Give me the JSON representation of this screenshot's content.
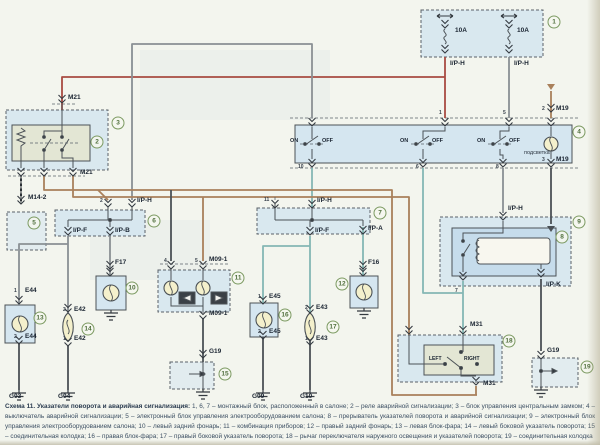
{
  "caption": {
    "title": "Схема 11. Указатели поворота и аварийная сигнализация:",
    "body": " 1, 6, 7 – монтажный блок, расположенный в салоне; 2 – реле аварийной сигнализации; 3 – блок управления центральным замком; 4 – выключатель аварийной сигнализации; 5 – электронный блок управления электрооборудованием салона; 8 – прерыватель указателей поворота и аварийной сигнализации; 9 – электронный блок управления электрооборудованием салона; 10 – левый задний фонарь; 11 – комбинация приборов; 12 – правый задний фонарь; 13 – левая блок-фара; 14 – левый боковой указатель поворота; 15 – соединительная колодка; 16 – правая блок-фара; 17 – правый боковой указатель поворота; 18 – рычаг переключателя наружного освещения и указателей поворота; 19 – соединительная колодка"
  },
  "colors": {
    "wire_red": "#a84b42",
    "wire_gray": "#8a9094",
    "wire_brown": "#a9805b",
    "wire_teal": "#84b7b4",
    "wire_dark": "#4b5156",
    "block_fill": "#cfe3f0",
    "inner_green": "#e3e6d4",
    "lamp_fill": "#f4f0cc",
    "ref_green": "#7c9a62"
  },
  "fuses": [
    {
      "rating": "10A",
      "output": "I/P-H"
    },
    {
      "rating": "10A",
      "output": "I/P-H"
    }
  ],
  "labels": [
    {
      "n": "fuse1-rating",
      "t": "10A",
      "x": 455,
      "y": 27
    },
    {
      "n": "fuse2-rating",
      "t": "10A",
      "x": 517,
      "y": 27
    },
    {
      "n": "fuse1-output",
      "t": "I/P-H",
      "x": 450,
      "y": 60
    },
    {
      "n": "fuse2-output",
      "t": "I/P-H",
      "x": 514,
      "y": 60
    },
    {
      "n": "m19-top-pin",
      "t": "2",
      "x": 542,
      "y": 106,
      "c": "sm"
    },
    {
      "n": "m19-top",
      "t": "M19",
      "x": 556,
      "y": 105
    },
    {
      "n": "m19-bottom-pin",
      "t": "3",
      "x": 542,
      "y": 157,
      "c": "sm"
    },
    {
      "n": "m19-bottom",
      "t": "M19",
      "x": 556,
      "y": 156
    },
    {
      "n": "sw1-on",
      "t": "ON",
      "x": 290,
      "y": 138,
      "c": "on"
    },
    {
      "n": "sw1-off",
      "t": "OFF",
      "x": 322,
      "y": 138,
      "c": "on"
    },
    {
      "n": "sw2-on",
      "t": "ON",
      "x": 400,
      "y": 138,
      "c": "on"
    },
    {
      "n": "sw2-off",
      "t": "OFF",
      "x": 432,
      "y": 138,
      "c": "on"
    },
    {
      "n": "sw3-on",
      "t": "ON",
      "x": 477,
      "y": 138,
      "c": "on"
    },
    {
      "n": "sw3-off",
      "t": "OFF",
      "x": 509,
      "y": 138,
      "c": "on"
    },
    {
      "n": "illumination",
      "t": "подсветка",
      "x": 524,
      "y": 150,
      "c": "ru"
    },
    {
      "n": "m21-top",
      "t": "M21",
      "x": 68,
      "y": 94
    },
    {
      "n": "m21-bottom",
      "t": "M21",
      "x": 80,
      "y": 169
    },
    {
      "n": "m14-2",
      "t": "M14-2",
      "x": 28,
      "y": 194
    },
    {
      "n": "b6-pin2",
      "t": "2",
      "x": 100,
      "y": 198,
      "c": "sm"
    },
    {
      "n": "b6-iph",
      "t": "I/P-H",
      "x": 137,
      "y": 197
    },
    {
      "n": "b6-ipf",
      "t": "I/P-F",
      "x": 73,
      "y": 227
    },
    {
      "n": "b6-ipb",
      "t": "I/P-B",
      "x": 115,
      "y": 227
    },
    {
      "n": "f17",
      "t": "F17",
      "x": 115,
      "y": 259
    },
    {
      "n": "b7-pin11",
      "t": "11",
      "x": 264,
      "y": 197,
      "c": "sm"
    },
    {
      "n": "b7-iph",
      "t": "I/P-H",
      "x": 317,
      "y": 197
    },
    {
      "n": "b7-ipf",
      "t": "I/P-F",
      "x": 315,
      "y": 227
    },
    {
      "n": "b7-ipa",
      "t": "I/P-A",
      "x": 368,
      "y": 225
    },
    {
      "n": "f16",
      "t": "F16",
      "x": 368,
      "y": 259
    },
    {
      "n": "m09-top",
      "t": "M09-1",
      "x": 209,
      "y": 256
    },
    {
      "n": "m09-pin4",
      "t": "4",
      "x": 164,
      "y": 258,
      "c": "sm"
    },
    {
      "n": "m09-pin5",
      "t": "5",
      "x": 195,
      "y": 258,
      "c": "sm"
    },
    {
      "n": "m09-bottom",
      "t": "M09-1",
      "x": 209,
      "y": 310
    },
    {
      "n": "g19-cluster",
      "t": "G19",
      "x": 209,
      "y": 348
    },
    {
      "n": "b9-iph",
      "t": "I/P-H",
      "x": 508,
      "y": 205
    },
    {
      "n": "b9-pin7",
      "t": "7",
      "x": 455,
      "y": 288,
      "c": "sm"
    },
    {
      "n": "ipk",
      "t": "I/P-K",
      "x": 546,
      "y": 281
    },
    {
      "n": "m31-top",
      "t": "M31",
      "x": 470,
      "y": 321
    },
    {
      "n": "m31-bottom",
      "t": "M31",
      "x": 483,
      "y": 380
    },
    {
      "n": "b4-pin1",
      "t": "1",
      "x": 439,
      "y": 110,
      "c": "sm"
    },
    {
      "n": "b4-pin5",
      "t": "5",
      "x": 503,
      "y": 110,
      "c": "sm"
    },
    {
      "n": "b4-pin10",
      "t": "10",
      "x": 298,
      "y": 164,
      "c": "sm"
    },
    {
      "n": "b4-pin6",
      "t": "6",
      "x": 416,
      "y": 164,
      "c": "sm"
    },
    {
      "n": "b4-pin8",
      "t": "8",
      "x": 496,
      "y": 164,
      "c": "sm"
    },
    {
      "n": "e44-1",
      "t": "E44",
      "x": 25,
      "y": 287
    },
    {
      "n": "e44-1-pin",
      "t": "1",
      "x": 14,
      "y": 288,
      "c": "sm"
    },
    {
      "n": "e44-2",
      "t": "E44",
      "x": 25,
      "y": 333
    },
    {
      "n": "e44-2-pin",
      "t": "2",
      "x": 14,
      "y": 334,
      "c": "sm"
    },
    {
      "n": "e42-2",
      "t": "E42",
      "x": 74,
      "y": 306
    },
    {
      "n": "e42-2-pin",
      "t": "2",
      "x": 63,
      "y": 307,
      "c": "sm"
    },
    {
      "n": "e42-1",
      "t": "E42",
      "x": 74,
      "y": 335
    },
    {
      "n": "e42-1-pin",
      "t": "1",
      "x": 63,
      "y": 336,
      "c": "sm"
    },
    {
      "n": "e45-1",
      "t": "E45",
      "x": 269,
      "y": 293
    },
    {
      "n": "e45-1-pin",
      "t": "1",
      "x": 258,
      "y": 294,
      "c": "sm"
    },
    {
      "n": "e45-2",
      "t": "E45",
      "x": 269,
      "y": 328
    },
    {
      "n": "e45-2-pin",
      "t": "2",
      "x": 258,
      "y": 329,
      "c": "sm"
    },
    {
      "n": "e43-2",
      "t": "E43",
      "x": 316,
      "y": 304
    },
    {
      "n": "e43-2-pin",
      "t": "2",
      "x": 305,
      "y": 305,
      "c": "sm"
    },
    {
      "n": "e43-1",
      "t": "E43",
      "x": 316,
      "y": 335
    },
    {
      "n": "e43-1-pin",
      "t": "1",
      "x": 305,
      "y": 336,
      "c": "sm"
    },
    {
      "n": "g03",
      "t": "G03",
      "x": 9,
      "y": 393
    },
    {
      "n": "g04",
      "t": "G04",
      "x": 58,
      "y": 393
    },
    {
      "n": "g09",
      "t": "G09",
      "x": 252,
      "y": 393
    },
    {
      "n": "g10",
      "t": "G10",
      "x": 300,
      "y": 393
    },
    {
      "n": "g19-right",
      "t": "G19",
      "x": 547,
      "y": 347
    },
    {
      "n": "lever-left",
      "t": "LEFT",
      "x": 429,
      "y": 356,
      "c": "sw"
    },
    {
      "n": "lever-right",
      "t": "RIGHT",
      "x": 464,
      "y": 356,
      "c": "sw"
    }
  ],
  "refs": [
    {
      "n": "1",
      "x": 554,
      "y": 22
    },
    {
      "n": "2",
      "x": 97,
      "y": 142
    },
    {
      "n": "3",
      "x": 118,
      "y": 123
    },
    {
      "n": "4",
      "x": 579,
      "y": 132
    },
    {
      "n": "5",
      "x": 34,
      "y": 223
    },
    {
      "n": "6",
      "x": 154,
      "y": 221
    },
    {
      "n": "7",
      "x": 380,
      "y": 213
    },
    {
      "n": "8",
      "x": 562,
      "y": 237
    },
    {
      "n": "9",
      "x": 579,
      "y": 222
    },
    {
      "n": "10",
      "x": 132,
      "y": 288
    },
    {
      "n": "11",
      "x": 238,
      "y": 278
    },
    {
      "n": "12",
      "x": 342,
      "y": 284
    },
    {
      "n": "13",
      "x": 40,
      "y": 318
    },
    {
      "n": "14",
      "x": 88,
      "y": 329
    },
    {
      "n": "15",
      "x": 225,
      "y": 374
    },
    {
      "n": "16",
      "x": 285,
      "y": 315
    },
    {
      "n": "17",
      "x": 333,
      "y": 327
    },
    {
      "n": "18",
      "x": 509,
      "y": 341
    },
    {
      "n": "19",
      "x": 587,
      "y": 367
    }
  ]
}
